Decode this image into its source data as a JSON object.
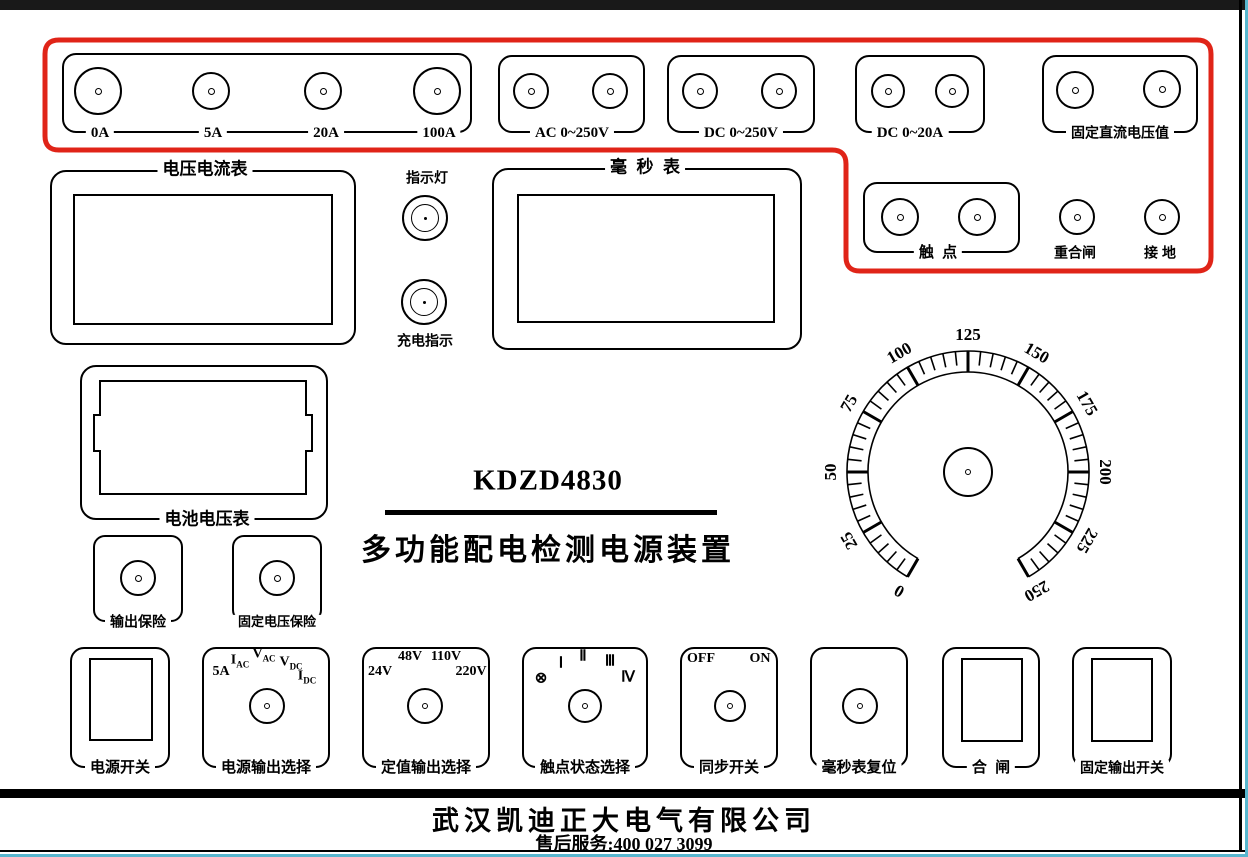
{
  "window": {
    "topbar_color": "#191919",
    "edge_color": "#58b6ce"
  },
  "panel": {
    "model": "KDZD4830",
    "subtitle": "多功能配电检测电源装置",
    "red_outline_color": "#e02418"
  },
  "terminals": {
    "current_group": {
      "labels": [
        "0A",
        "5A",
        "20A",
        "100A"
      ]
    },
    "ac_250v": {
      "label": "AC 0~250V"
    },
    "dc_250v": {
      "label": "DC 0~250V"
    },
    "dc_20a": {
      "label": "DC 0~20A"
    },
    "fixed_dc": {
      "label": "固定直流电压值"
    },
    "contact": {
      "label": "触  点"
    },
    "reclose": {
      "label": "重合闸"
    },
    "ground": {
      "label": "接 地"
    }
  },
  "meters": {
    "volt_ammeter": {
      "label": "电压电流表"
    },
    "millisecond": {
      "label": "毫  秒  表"
    },
    "battery": {
      "label": "电池电压表"
    }
  },
  "lamps": {
    "indicator": {
      "label": "指示灯"
    },
    "charge": {
      "label": "充电指示"
    }
  },
  "fuses": {
    "output": {
      "label": "输出保险"
    },
    "fixed_voltage": {
      "label": "固定电压保险"
    }
  },
  "dial": {
    "min": 0,
    "max": 250,
    "major_step": 25,
    "minor_step": 5,
    "start_deg": -150,
    "end_deg": 150,
    "labels": [
      "0",
      "25",
      "50",
      "75",
      "100",
      "125",
      "150",
      "175",
      "200",
      "225",
      "250"
    ]
  },
  "controls": {
    "power_switch": {
      "label": "电源开关"
    },
    "output_select": {
      "label": "电源输出选择",
      "positions": [
        {
          "main": "5A",
          "sub": ""
        },
        {
          "main": "I",
          "sub": "AC"
        },
        {
          "main": "V",
          "sub": "AC"
        },
        {
          "main": "V",
          "sub": "DC"
        },
        {
          "main": "I",
          "sub": "DC"
        }
      ]
    },
    "fixed_select": {
      "label": "定值输出选择",
      "positions": [
        "24V",
        "48V",
        "110V",
        "220V"
      ]
    },
    "contact_select": {
      "label": "触点状态选择",
      "positions": [
        "⊗",
        "Ⅰ",
        "Ⅱ",
        "Ⅲ",
        "Ⅳ"
      ]
    },
    "sync_switch": {
      "label": "同步开关",
      "positions": [
        "OFF",
        "ON"
      ]
    },
    "ms_reset": {
      "label": "毫秒表复位"
    },
    "close_switch": {
      "label": "合  闸"
    },
    "fixed_output_switch": {
      "label": "固定输出开关"
    }
  },
  "footer": {
    "company": "武汉凯迪正大电气有限公司",
    "service": "售后服务:400 027 3099"
  }
}
